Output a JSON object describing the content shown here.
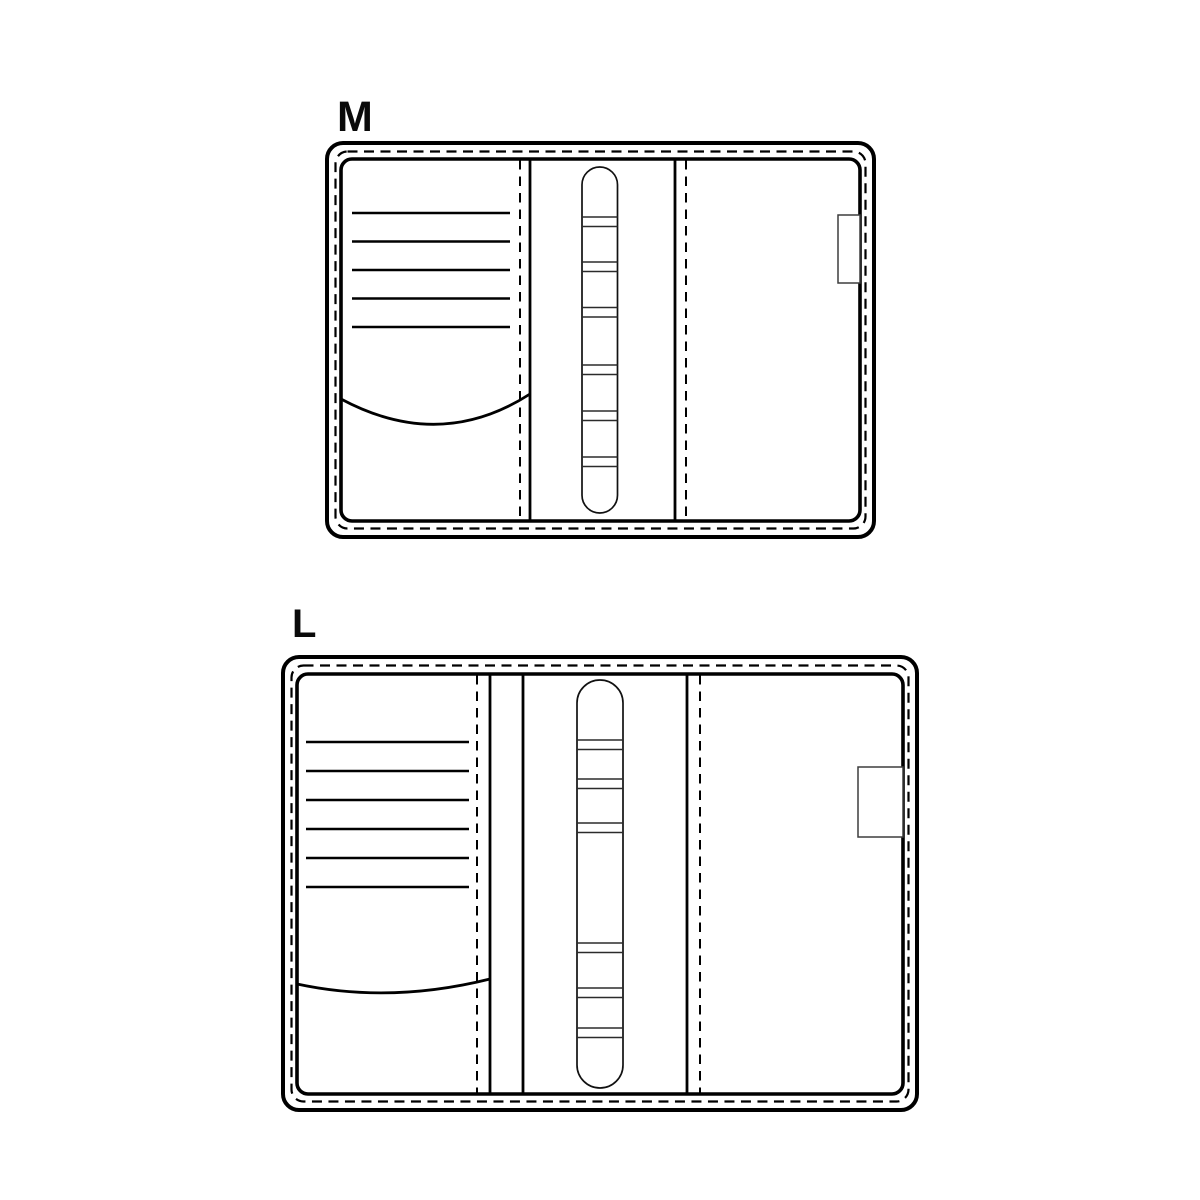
{
  "page": {
    "background_color": "#ffffff",
    "line_color": "#000000"
  },
  "diagrams": [
    {
      "label": "M",
      "card_slot_lines": 5,
      "pen_loop_bands": 6,
      "has_closure_tab": true
    },
    {
      "label": "L",
      "card_slot_lines": 6,
      "pen_loop_bands": 6,
      "has_closure_tab": true
    }
  ]
}
